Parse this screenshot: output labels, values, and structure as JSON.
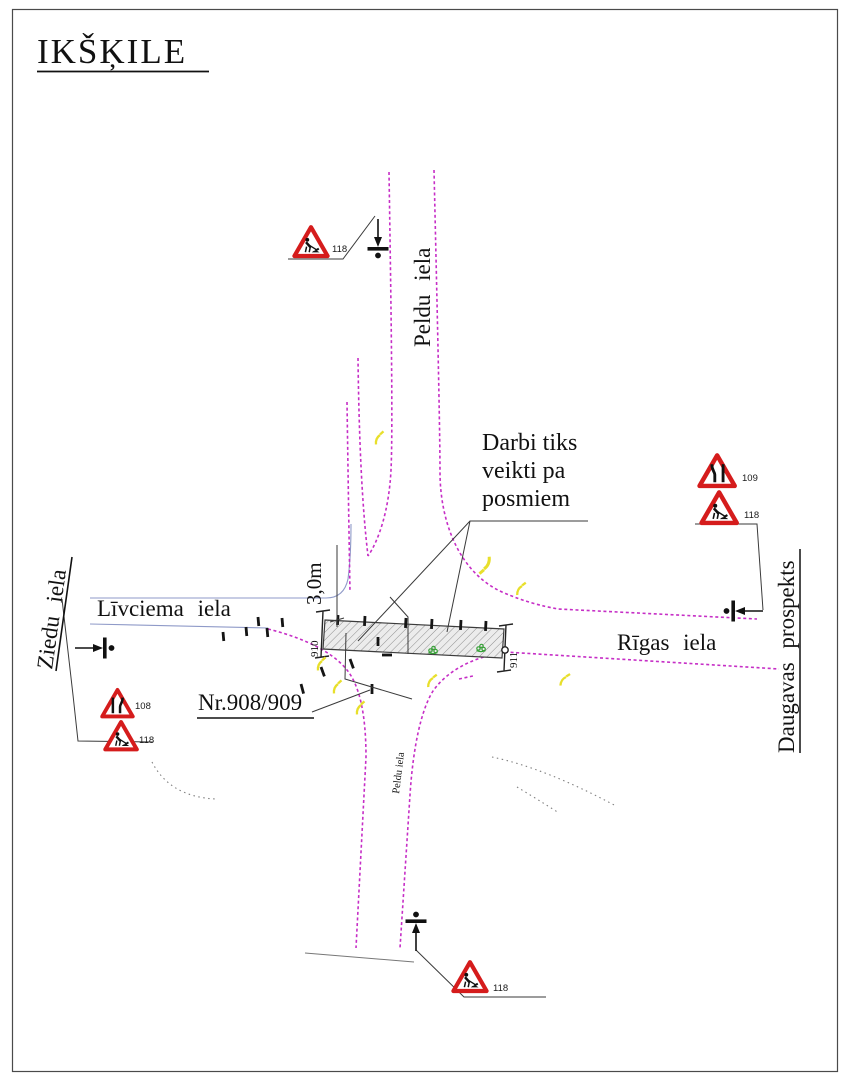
{
  "title": "IKŠĶILE",
  "streets": {
    "peldu_north": "Peldu iela",
    "peldu_south": "Peldu iela",
    "livciema": "Līvciema iela",
    "ziedu": "Ziedu iela",
    "rigas": "Rīgas iela",
    "daugavas": "Daugavas prospekts"
  },
  "annotations": {
    "note_line1": "Darbi tiks",
    "note_line2": "veikti pa",
    "note_line3": "posmiem",
    "dimension": "3,0m",
    "object_ref": "Nr.908/909",
    "station_left": "910",
    "station_right": "911"
  },
  "signs": {
    "north": [
      {
        "code": "118",
        "type": "roadworks"
      }
    ],
    "west": [
      {
        "code": "108",
        "type": "road-narrows"
      },
      {
        "code": "118",
        "type": "roadworks"
      }
    ],
    "east": [
      {
        "code": "109",
        "type": "road-narrows"
      },
      {
        "code": "118",
        "type": "roadworks"
      }
    ],
    "south": [
      {
        "code": "118",
        "type": "roadworks"
      }
    ]
  },
  "colors": {
    "road_edge_magenta": "#c62ec6",
    "secondary_edge_blue": "#8f9ac8",
    "sign_red": "#d51c1c",
    "marking_yellow": "#e8df2b",
    "vegetation_green": "#36a036",
    "frame": "#4a4a4a"
  }
}
